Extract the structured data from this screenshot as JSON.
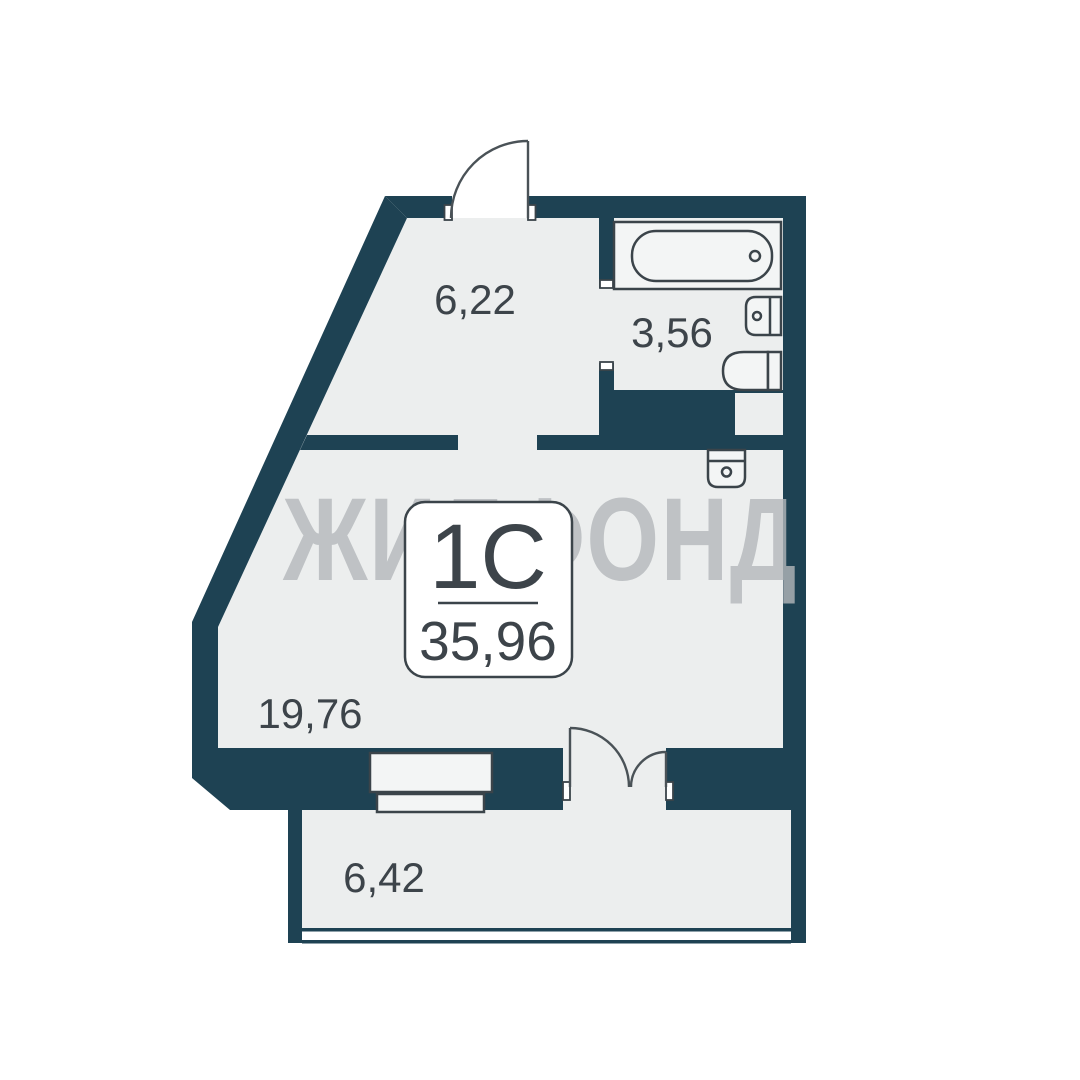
{
  "watermark": "ЖИЛФОНД",
  "unit_card": {
    "type": "1С",
    "area": "35,96"
  },
  "rooms": [
    {
      "name": "hallway",
      "area": "6,22"
    },
    {
      "name": "bathroom",
      "area": "3,56"
    },
    {
      "name": "living-room",
      "area": "19,76"
    },
    {
      "name": "balcony",
      "area": "6,42"
    }
  ],
  "colors": {
    "wall": "#1e4253",
    "floor": "#eceeee",
    "fixture": "#f3f5f5",
    "outline": "#3b444a",
    "doorline": "#4a5257",
    "watermark": "#b4b8bb",
    "text": "#3d444a"
  }
}
